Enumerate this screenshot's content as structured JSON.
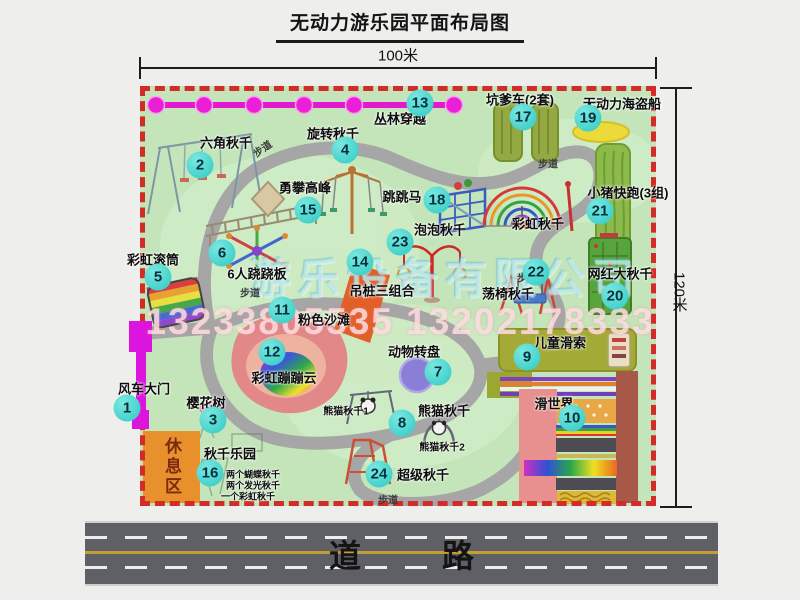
{
  "title": "无动力游乐园平面布局图",
  "dimension_top": "100米",
  "dimension_right": "120米",
  "road_label": "道 路",
  "rest_area_label": "休息区",
  "walkway_label": "步道",
  "watermark": {
    "company": "游乐设备有限公司",
    "phone": "13233805535 13202178333"
  },
  "attractions": [
    {
      "num": "1",
      "label": "风车大门"
    },
    {
      "num": "2",
      "label": "六角秋千"
    },
    {
      "num": "3",
      "label": "樱花树"
    },
    {
      "num": "4",
      "label": "旋转秋千"
    },
    {
      "num": "5",
      "label": "彩虹滚筒"
    },
    {
      "num": "6",
      "label": "6人跷跷板"
    },
    {
      "num": "7",
      "label": "动物转盘"
    },
    {
      "num": "8",
      "label": "熊猫秋千"
    },
    {
      "num": "9",
      "label": "儿童滑索"
    },
    {
      "num": "10",
      "label": "滑世界"
    },
    {
      "num": "11",
      "label": "粉色沙滩"
    },
    {
      "num": "12",
      "label": "彩虹蹦蹦云"
    },
    {
      "num": "13",
      "label": "丛林穿越"
    },
    {
      "num": "14",
      "label": "吊桩三组合"
    },
    {
      "num": "15",
      "label": "勇攀高峰"
    },
    {
      "num": "16",
      "label": "秋千乐园"
    },
    {
      "num": "17",
      "label": "坑爹车(2套)"
    },
    {
      "num": "18",
      "label": "跳跳马"
    },
    {
      "num": "19",
      "label": "无动力海盗船"
    },
    {
      "num": "20",
      "label": "网红大秋千"
    },
    {
      "num": "21",
      "label": "小猪快跑(3组)"
    },
    {
      "num": "22",
      "label": "荡椅秋千"
    },
    {
      "num": "23",
      "label": "泡泡秋千"
    },
    {
      "num": "24",
      "label": "超级秋千"
    }
  ],
  "secondary_labels": {
    "rainbow_swing": "彩虹秋千",
    "panda_swing_1": "熊猫秋千1",
    "panda_swing_2": "熊猫秋千2"
  },
  "swing_park_items": [
    "两个蝴蝶秋千",
    "两个发光秋千",
    "一个彩虹秋千"
  ],
  "colors": {
    "map_green": "#c4e5ba",
    "border_red": "#d32a2a",
    "badge_cyan": "#2fc9c4",
    "gate_magenta": "#dd14dd",
    "road_gray": "#5f5f66"
  }
}
